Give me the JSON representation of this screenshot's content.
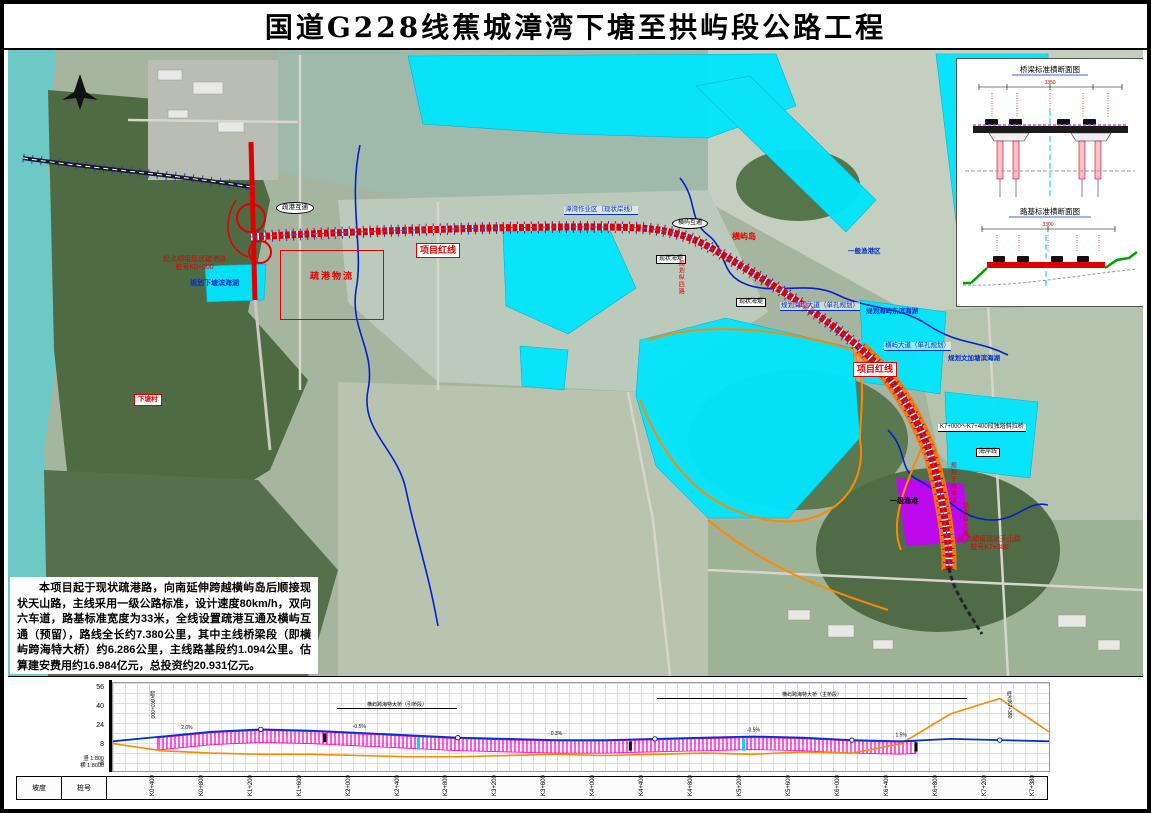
{
  "title": "国道G228线蕉城漳湾下塘至拱屿段公路工程",
  "description": "本项目起于现状疏港路，向南延伸跨越横屿岛后顺接现状天山路，主线采用一级公路标准，设计速度80km/h，双向六车道，路基标准宽度为33米，全线设置疏港互通及横屿互通（预留），路线全长约7.380公里，其中主线桥梁段（即横屿跨海特大桥）约6.286公里，主线路基段约1.094公里。估算建安费用约16.984亿元，总投资约20.931亿元。",
  "map": {
    "labels": {
      "start_point": "起点顺接现状疏港路",
      "start_station": "桩号K0+000",
      "end_point": "终点顺接现状天山路",
      "end_station": "桩号K7+380",
      "redline1": "项目红线",
      "redline2": "项目红线",
      "ic1": "疏港互通",
      "ic2": "横屿互通",
      "lake1": "规划下塘滨海湖",
      "lake2": "规划海屿东滨海湖",
      "lake3": "规划文加塘滨海湖",
      "logistics": "疏港物流",
      "workzone": "漳湾作业区（现状岸线）",
      "island": "横屿岛",
      "seawall1": "现状海堤",
      "seawall2": "现状海堤",
      "road_z4": "规划纵四路",
      "seawall_road": "规划海堤大道（单孔规划）",
      "hengyu_road": "横屿大道（单孔规划）",
      "fishport_zone": "一般渔港区",
      "bridge_note": "K7+000～K7+400段独塔斜拉桥",
      "coastline": "海岸线",
      "greenway": "规划干线绿道",
      "road_z6": "规划纵六路",
      "fishport": "一级渔港",
      "village": "下塘村"
    }
  },
  "inset": {
    "bridge_title": "桥梁标准横断面图",
    "bridge_dim": "3350",
    "subgrade_title": "路基标准横断面图",
    "subgrade_dim": "3300"
  },
  "profile": {
    "row_label_1": "坡度",
    "row_label_2": "桩号",
    "span_label_1": "横屿跨海特大桥（引桥段）",
    "span_label_2": "横屿跨海特大桥（主桥段）",
    "scale_v": "竖 1:800",
    "scale_h": "横 1:8000",
    "start_label": "起点K0+000",
    "end_label": "终点K7+380",
    "grades": [
      "2.0%",
      "-0.5%",
      "0.3%",
      "-0.5%",
      "1.5%"
    ]
  },
  "chart_data": {
    "type": "line",
    "x": [
      "K0+000",
      "K0+400",
      "K0+800",
      "K1+200",
      "K1+600",
      "K2+000",
      "K2+400",
      "K2+800",
      "K3+200",
      "K3+600",
      "K4+000",
      "K4+400",
      "K4+800",
      "K5+200",
      "K5+600",
      "K6+000",
      "K6+400",
      "K6+800",
      "K7+200",
      "K7+380"
    ],
    "y_ticks": [
      56,
      40,
      24,
      8,
      -8
    ],
    "series": [
      {
        "name": "设计线",
        "color": "#0033cc",
        "values": [
          12,
          16,
          20,
          22,
          21,
          19,
          17,
          15,
          14,
          13,
          13,
          14,
          15,
          16,
          15,
          13,
          12,
          14,
          13,
          12
        ]
      },
      {
        "name": "地面线",
        "color": "#ff8800",
        "values": [
          10,
          4,
          2,
          1,
          1,
          0,
          -1,
          -1,
          0,
          1,
          0,
          1,
          2,
          1,
          3,
          2,
          10,
          35,
          48,
          20
        ]
      }
    ],
    "bridge_band": {
      "from_index": 0.9,
      "to_index": 16.6,
      "color": "#ff00cc",
      "label": "横屿跨海特大桥 L=6286m"
    },
    "legend_position": "none",
    "grid": true
  }
}
